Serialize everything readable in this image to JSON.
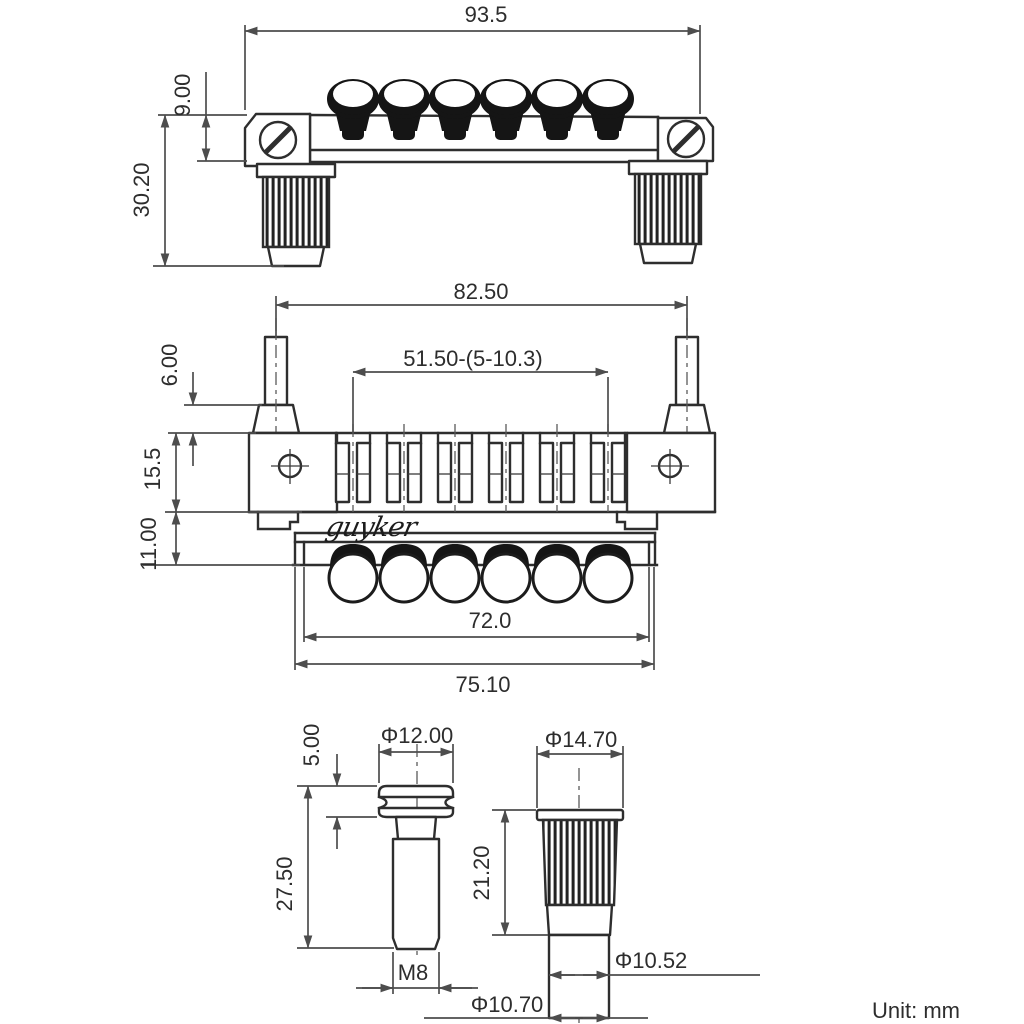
{
  "front_view": {
    "overall_width": "93.5",
    "rail_height": "9.00",
    "overall_height": "30.20"
  },
  "bottom_view": {
    "post_spacing": "82.50",
    "saddle_adjust_range": "51.50-(5-10.3)",
    "post_top_height": "6.00",
    "body_height": "15.5",
    "base_height": "11.00",
    "plate_width": "72.0",
    "base_width": "75.10"
  },
  "stud_detail": {
    "collar_height": "5.00",
    "head_diameter": "Φ12.00",
    "shank_length": "27.50",
    "thread_spec": "M8"
  },
  "bushing_detail": {
    "head_diameter": "Φ14.70",
    "body_length": "21.20",
    "inner_diameter": "Φ10.52",
    "outer_diameter": "Φ10.70"
  },
  "brand_logo": "guyker",
  "unit_note": "Unit: mm"
}
